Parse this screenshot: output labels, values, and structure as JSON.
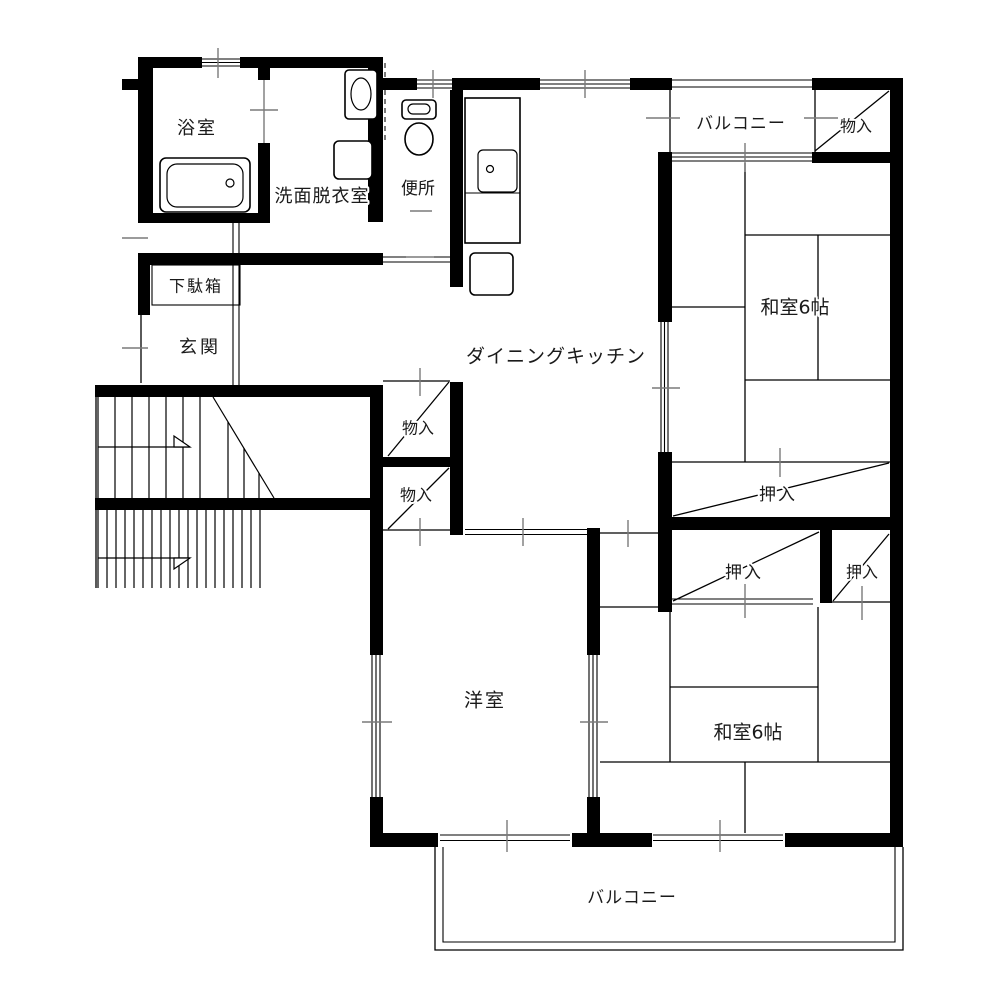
{
  "plan_title": "2LDK floor plan",
  "colors": {
    "background": "#ffffff",
    "wall": "#000000",
    "line": "#000000",
    "tick": "#7a7a7a",
    "text": "#1a1a1a"
  },
  "rooms": {
    "bathroom": {
      "label": "浴室"
    },
    "washroom": {
      "label": "洗面脱衣室"
    },
    "toilet": {
      "label": "便所"
    },
    "shoe_cabinet": {
      "label": "下駄箱"
    },
    "entrance": {
      "label": "玄関"
    },
    "dining_kitchen": {
      "label": "ダイニングキッチン"
    },
    "balcony_top": {
      "label": "バルコニー"
    },
    "storage_top_right": {
      "label": "物入"
    },
    "japanese_room_upper": {
      "label": "和室6帖"
    },
    "closet_upper": {
      "label": "押入"
    },
    "storage_mid_upper": {
      "label": "物入"
    },
    "storage_mid_lower": {
      "label": "物入"
    },
    "closet_lower_left": {
      "label": "押入"
    },
    "closet_lower_right": {
      "label": "押入"
    },
    "japanese_room_lower": {
      "label": "和室6帖"
    },
    "western_room": {
      "label": "洋室"
    },
    "balcony_bottom": {
      "label": "バルコニー"
    }
  },
  "fixtures": [
    "bathtub",
    "washing-machine",
    "wash-basin",
    "toilet-bowl",
    "kitchen-sink",
    "stove",
    "staircase"
  ]
}
